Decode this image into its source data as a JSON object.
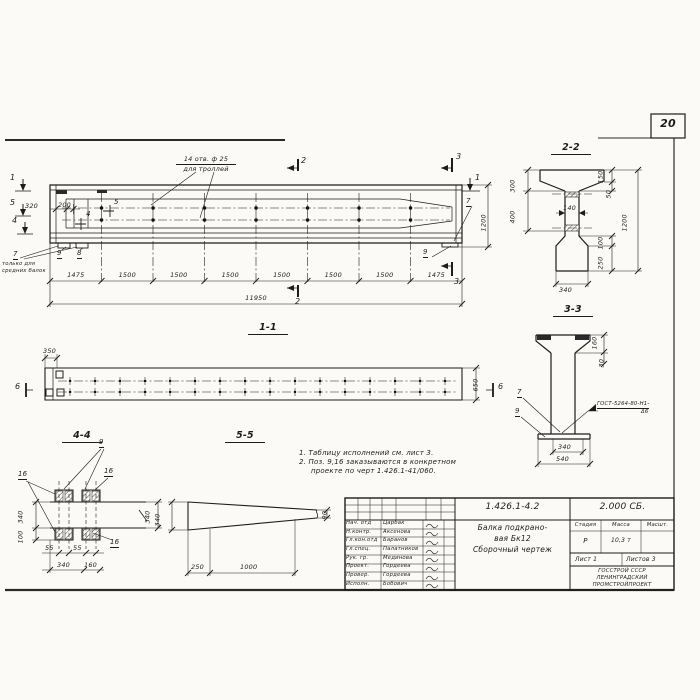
{
  "sheet": {
    "number": "20"
  },
  "colors": {
    "ink": "#1c1c1c",
    "paper": "#fbfaf6"
  },
  "elevation": {
    "callout": {
      "line1": "14 отв. ф 25",
      "line2": "для троллей"
    },
    "dim_320": "320",
    "dim_200": "200",
    "dim_1200": "1200",
    "flag_5": "5",
    "flag_4": "4",
    "marker_1": "1",
    "marker_5": "5",
    "marker_4": "4",
    "marker_2": "2",
    "marker_3": "3",
    "pos_7": "7",
    "pos_8": "8",
    "pos_9": "9",
    "pos7_note": {
      "line1": "только для",
      "line2": "средних балок"
    },
    "segments": [
      "1475",
      "1500",
      "1500",
      "1500",
      "1500",
      "1500",
      "1500",
      "1475"
    ],
    "total": "11950"
  },
  "section22": {
    "title": "2-2",
    "dim_300": "300",
    "dim_400": "400",
    "dim_140": "140",
    "dim_150": "150",
    "dim_50": "50",
    "dim_1200": "1200",
    "dim_100": "100",
    "dim_250": "250",
    "dim_340": "340"
  },
  "section33": {
    "title": "3-3",
    "dim_160": "160",
    "dim_30": "30",
    "dim_340": "340",
    "dim_540": "540",
    "pos_7": "7",
    "pos_9": "9",
    "weld_line1": "ГОСТ-5264-80-Н1-",
    "weld_line2": "Δ6"
  },
  "section11": {
    "title": "1-1",
    "dim_350": "350",
    "dim_650": "650",
    "marker_6_left": "6",
    "marker_6_right": "6"
  },
  "section44": {
    "title": "4-4",
    "pos_9": "9",
    "pos_16": "16",
    "dim_340_left": "340",
    "dim_100": "100",
    "dim_55_1": "55",
    "dim_55_2": "55",
    "dim_340_bottom": "340",
    "dim_160": "160",
    "dim_340_right": "340"
  },
  "section55": {
    "title": "5-5",
    "dim_340": "340",
    "dim_90": "90",
    "dim_250": "250",
    "dim_1000": "1000"
  },
  "notes": {
    "line1": "1. Таблицу исполнений см. лист 3.",
    "line2": "2. Поз. 9,16 заказываются в конкретном",
    "line3": "проекте по черт 1.426.1-41/060."
  },
  "titleblock": {
    "doc_number": "1.426.1-4.2",
    "doc_code": "2.000 СБ.",
    "title_line1": "Балка подкрано-",
    "title_line2": "вая Бк12",
    "title_line3": "Сборочный чертеж",
    "col_stage": "Стадия",
    "col_mass": "Масса",
    "col_scale": "Масшт.",
    "stage": "Р",
    "mass": "10,3 т",
    "sheet_label": "Лист 1",
    "sheets_label": "Листов 3",
    "org_line1": "ГОССТРОЙ СССР",
    "org_line2": "ЛЕНИНГРАДСКИЙ",
    "org_line3": "ПРОМСТРОЙПРОЕКТ",
    "rows": [
      {
        "role": "Нач. отд",
        "name": "Царбак"
      },
      {
        "role": "Н.контр.",
        "name": "Аксенова"
      },
      {
        "role": "Гл.кон.отд",
        "name": "Баранов"
      },
      {
        "role": "Гл.спец.",
        "name": "Палатников"
      },
      {
        "role": "Рук. гр.",
        "name": "Мединова"
      },
      {
        "role": "Проект.",
        "name": "Гордеева"
      },
      {
        "role": "Провер.",
        "name": "Гордеева"
      },
      {
        "role": "Исполн.",
        "name": "Бобович"
      }
    ]
  }
}
